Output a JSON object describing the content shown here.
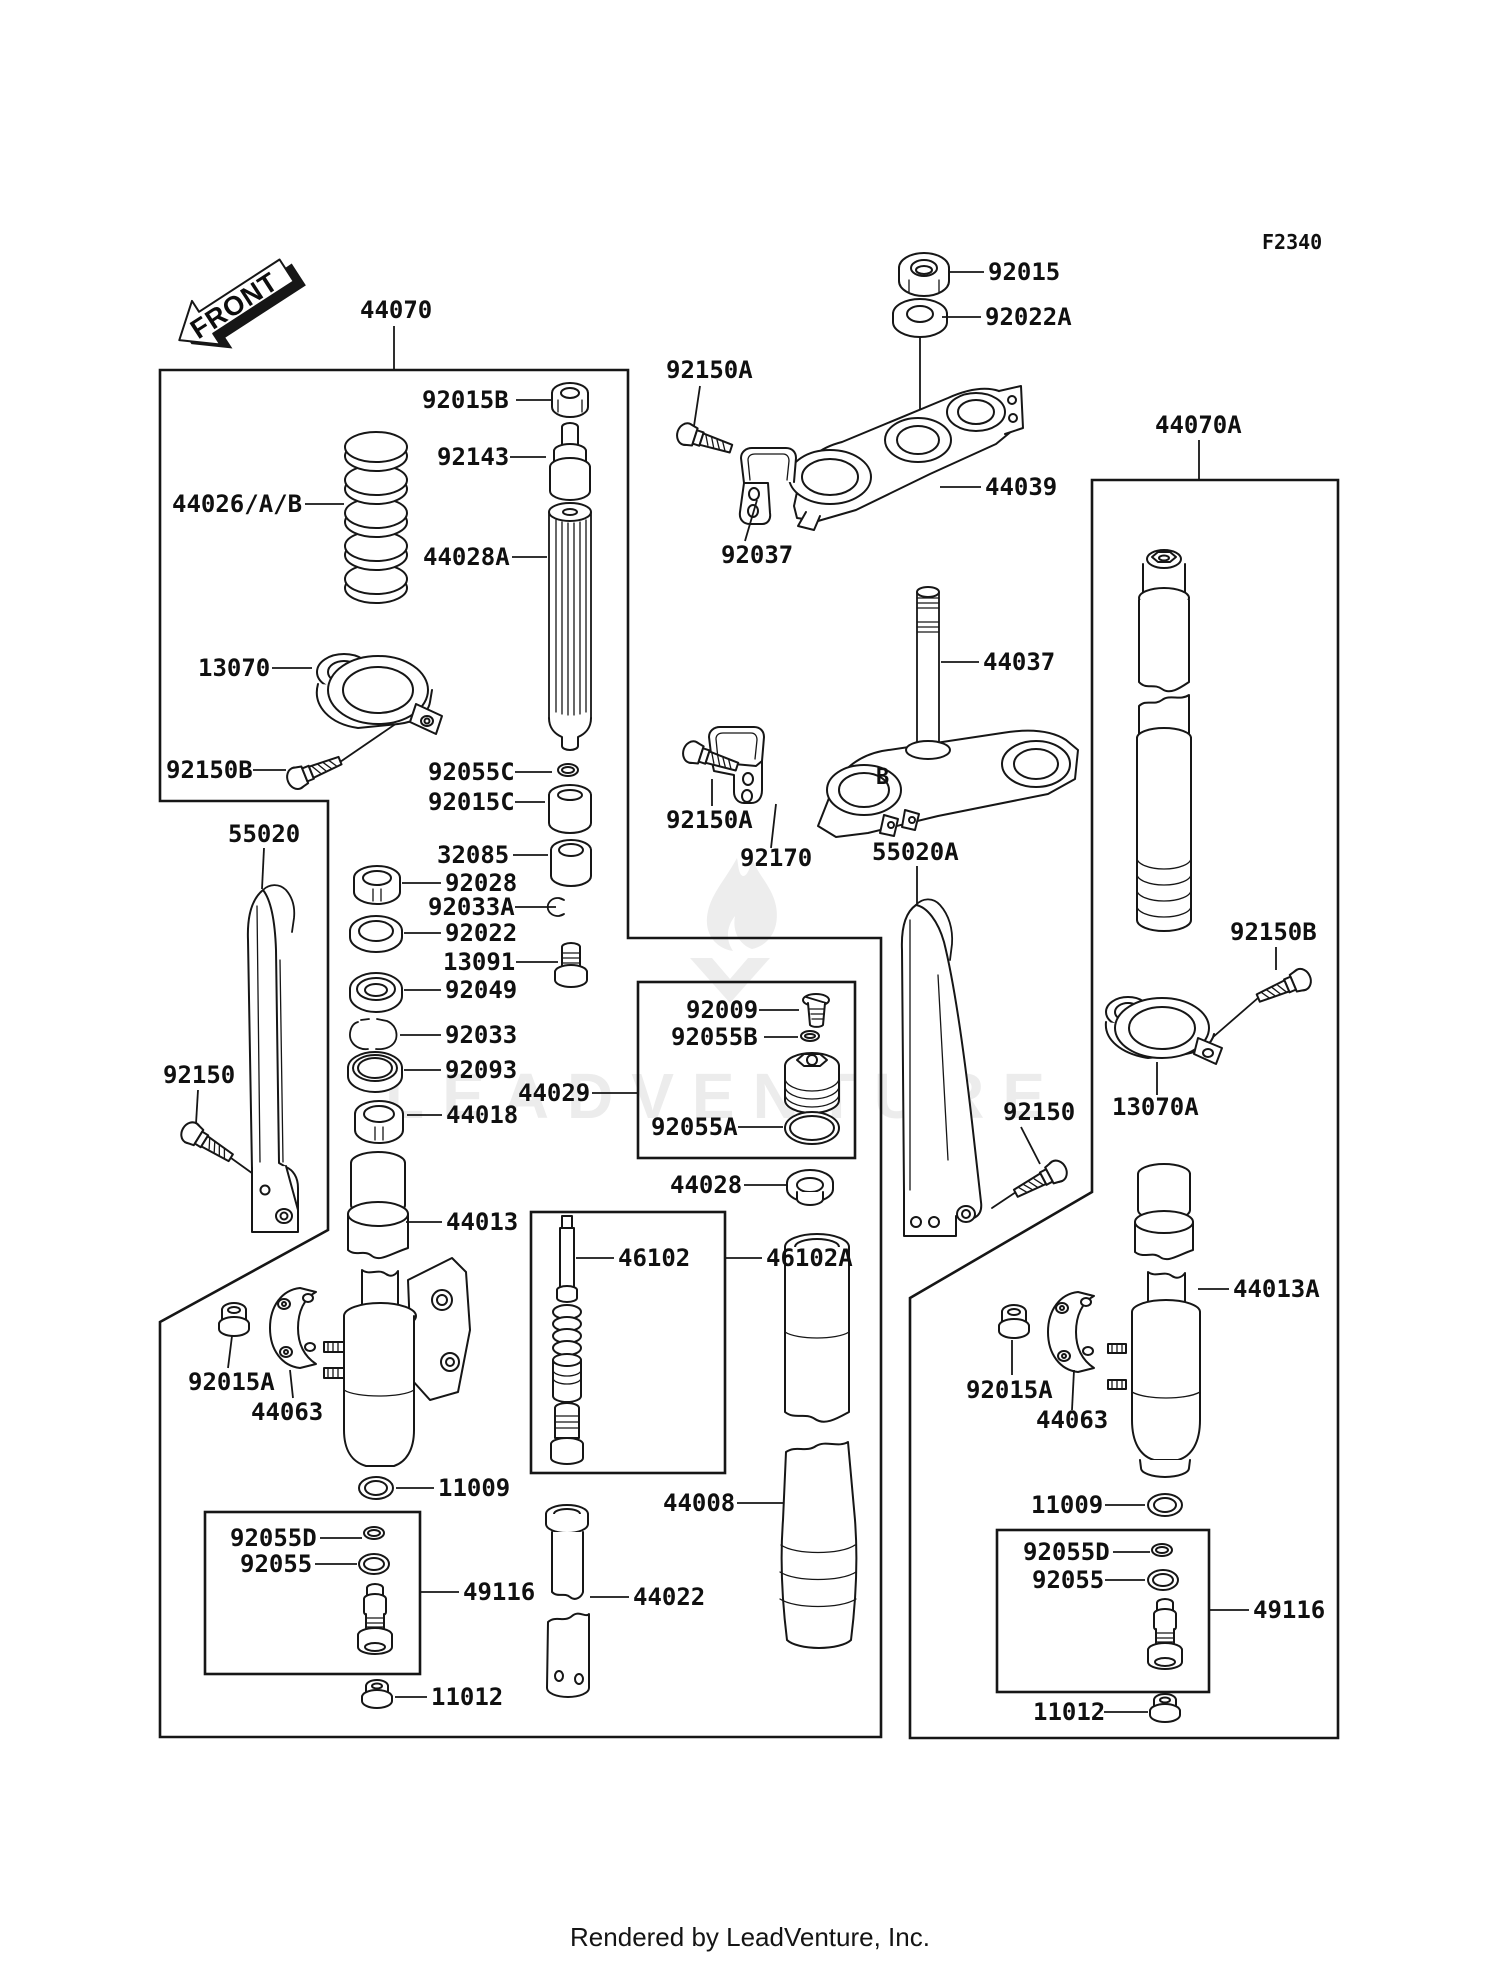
{
  "page": {
    "diagram_code": "F2340",
    "front_label": "FRONT",
    "clamp_marking": "B",
    "watermark_text": "LEADVENTURE",
    "footer_text": "Rendered by LeadVenture, Inc.",
    "line_color": "#161616",
    "background_color": "#ffffff",
    "watermark_color": "#ececec"
  },
  "diagram": {
    "labels": [
      {
        "id": "92015",
        "text": "92015",
        "x": 988,
        "y": 280,
        "leader": [
          984,
          272,
          948,
          272
        ]
      },
      {
        "id": "92022A",
        "text": "92022A",
        "x": 985,
        "y": 325,
        "leader": [
          981,
          317,
          942,
          317
        ]
      },
      {
        "id": "44070",
        "text": "44070",
        "x": 360,
        "y": 318,
        "leader": [
          394,
          326,
          394,
          369
        ]
      },
      {
        "id": "44070A",
        "text": "44070A",
        "x": 1155,
        "y": 433,
        "leader": [
          1199,
          440,
          1199,
          479
        ]
      },
      {
        "id": "92015B",
        "text": "92015B",
        "x": 422,
        "y": 408,
        "leader": [
          516,
          400,
          551,
          400
        ]
      },
      {
        "id": "92143",
        "text": "92143",
        "x": 437,
        "y": 465,
        "leader": [
          510,
          457,
          546,
          457
        ]
      },
      {
        "id": "44026AB",
        "text": "44026/A/B",
        "x": 172,
        "y": 512,
        "leader": [
          305,
          504,
          344,
          504
        ]
      },
      {
        "id": "44028A",
        "text": "44028A",
        "x": 423,
        "y": 565,
        "leader": [
          512,
          557,
          547,
          557
        ]
      },
      {
        "id": "13070",
        "text": "13070",
        "x": 198,
        "y": 676,
        "leader": [
          272,
          668,
          312,
          668
        ]
      },
      {
        "id": "92150B-left",
        "text": "92150B",
        "x": 166,
        "y": 778,
        "leader": [
          253,
          770,
          286,
          770
        ]
      },
      {
        "id": "92055C",
        "text": "92055C",
        "x": 428,
        "y": 780,
        "leader": [
          515,
          772,
          552,
          772
        ]
      },
      {
        "id": "92015C",
        "text": "92015C",
        "x": 428,
        "y": 810,
        "leader": [
          515,
          802,
          545,
          802
        ]
      },
      {
        "id": "55020",
        "text": "55020",
        "x": 228,
        "y": 842,
        "leader": [
          264,
          848,
          262,
          889
        ]
      },
      {
        "id": "32085",
        "text": "32085",
        "x": 437,
        "y": 863,
        "leader": [
          513,
          855,
          548,
          855
        ]
      },
      {
        "id": "92028",
        "text": "92028",
        "x": 445,
        "y": 891,
        "leader": [
          441,
          883,
          402,
          883
        ]
      },
      {
        "id": "92033A",
        "text": "92033A",
        "x": 428,
        "y": 915,
        "leader": [
          515,
          907,
          556,
          907
        ]
      },
      {
        "id": "92022",
        "text": "92022",
        "x": 445,
        "y": 941,
        "leader": [
          441,
          933,
          404,
          933
        ]
      },
      {
        "id": "13091",
        "text": "13091",
        "x": 443,
        "y": 970,
        "leader": [
          516,
          962,
          558,
          962
        ]
      },
      {
        "id": "92049",
        "text": "92049",
        "x": 445,
        "y": 998,
        "leader": [
          441,
          990,
          404,
          990
        ]
      },
      {
        "id": "92033",
        "text": "92033",
        "x": 445,
        "y": 1043,
        "leader": [
          441,
          1035,
          400,
          1035
        ]
      },
      {
        "id": "92093",
        "text": "92093",
        "x": 445,
        "y": 1078,
        "leader": [
          441,
          1070,
          404,
          1070
        ]
      },
      {
        "id": "44029",
        "text": "44029",
        "x": 518,
        "y": 1101,
        "leader": [
          592,
          1093,
          637,
          1093
        ]
      },
      {
        "id": "44018",
        "text": "44018",
        "x": 446,
        "y": 1123,
        "leader": [
          442,
          1115,
          407,
          1115
        ]
      },
      {
        "id": "92150-left",
        "text": "92150",
        "x": 163,
        "y": 1083,
        "leader": [
          198,
          1090,
          196,
          1124
        ]
      },
      {
        "id": "44013",
        "text": "44013",
        "x": 446,
        "y": 1230,
        "leader": [
          442,
          1222,
          406,
          1222
        ]
      },
      {
        "id": "92015A-left",
        "text": "92015A",
        "x": 188,
        "y": 1390,
        "leader": [
          232,
          1336,
          228,
          1368
        ]
      },
      {
        "id": "44063-left",
        "text": "44063",
        "x": 251,
        "y": 1420,
        "leader": [
          293,
          1398,
          290,
          1370
        ]
      },
      {
        "id": "11009-left",
        "text": "11009",
        "x": 438,
        "y": 1496,
        "leader": [
          434,
          1488,
          396,
          1488
        ]
      },
      {
        "id": "92055D-left",
        "text": "92055D",
        "x": 230,
        "y": 1546,
        "leader": [
          320,
          1538,
          362,
          1538
        ]
      },
      {
        "id": "92055-left",
        "text": "92055",
        "x": 240,
        "y": 1572,
        "leader": [
          315,
          1564,
          357,
          1564
        ]
      },
      {
        "id": "49116-left",
        "text": "49116",
        "x": 463,
        "y": 1600,
        "leader": [
          459,
          1592,
          420,
          1592
        ]
      },
      {
        "id": "11012-left",
        "text": "11012",
        "x": 431,
        "y": 1705,
        "leader": [
          427,
          1697,
          395,
          1697
        ]
      },
      {
        "id": "92150A-top",
        "text": "92150A",
        "x": 666,
        "y": 378,
        "leader": [
          700,
          386,
          694,
          426
        ]
      },
      {
        "id": "92037",
        "text": "92037",
        "x": 721,
        "y": 563,
        "leader": [
          757,
          500,
          745,
          541
        ]
      },
      {
        "id": "44039",
        "text": "44039",
        "x": 985,
        "y": 495,
        "leader": [
          981,
          487,
          940,
          487
        ]
      },
      {
        "id": "44037",
        "text": "44037",
        "x": 983,
        "y": 670,
        "leader": [
          979,
          662,
          941,
          662
        ]
      },
      {
        "id": "92150A-mid",
        "text": "92150A",
        "x": 666,
        "y": 828,
        "leader": [
          712,
          779,
          712,
          806
        ]
      },
      {
        "id": "92170",
        "text": "92170",
        "x": 740,
        "y": 866,
        "leader": [
          776,
          804,
          771,
          848
        ]
      },
      {
        "id": "55020A",
        "text": "55020A",
        "x": 872,
        "y": 860,
        "leader": [
          917,
          866,
          917,
          904
        ]
      },
      {
        "id": "92150-right",
        "text": "92150",
        "x": 1003,
        "y": 1120,
        "leader": [
          1021,
          1127,
          1040,
          1164
        ]
      },
      {
        "id": "92009",
        "text": "92009",
        "x": 686,
        "y": 1018,
        "leader": [
          759,
          1010,
          799,
          1010
        ]
      },
      {
        "id": "92055B",
        "text": "92055B",
        "x": 671,
        "y": 1045,
        "leader": [
          764,
          1037,
          798,
          1037
        ]
      },
      {
        "id": "92055A",
        "text": "92055A",
        "x": 651,
        "y": 1135,
        "leader": [
          738,
          1127,
          783,
          1127
        ]
      },
      {
        "id": "44028",
        "text": "44028",
        "x": 670,
        "y": 1193,
        "leader": [
          744,
          1185,
          786,
          1185
        ]
      },
      {
        "id": "46102",
        "text": "46102",
        "x": 618,
        "y": 1266,
        "leader": [
          614,
          1258,
          576,
          1258
        ]
      },
      {
        "id": "46102A",
        "text": "46102A",
        "x": 766,
        "y": 1266,
        "leader": [
          762,
          1258,
          725,
          1258
        ]
      },
      {
        "id": "44008",
        "text": "44008",
        "x": 663,
        "y": 1511,
        "leader": [
          737,
          1503,
          783,
          1503
        ]
      },
      {
        "id": "44022",
        "text": "44022",
        "x": 633,
        "y": 1605,
        "leader": [
          629,
          1597,
          590,
          1597
        ]
      },
      {
        "id": "13070A",
        "text": "13070A",
        "x": 1112,
        "y": 1115,
        "leader": [
          1157,
          1062,
          1157,
          1095
        ]
      },
      {
        "id": "92150B-right",
        "text": "92150B",
        "x": 1230,
        "y": 940,
        "leader": [
          1276,
          947,
          1276,
          970
        ]
      },
      {
        "id": "44013A",
        "text": "44013A",
        "x": 1233,
        "y": 1297,
        "leader": [
          1229,
          1289,
          1198,
          1289
        ]
      },
      {
        "id": "92015A-right",
        "text": "92015A",
        "x": 966,
        "y": 1398,
        "leader": [
          1012,
          1340,
          1012,
          1375
        ]
      },
      {
        "id": "44063-right",
        "text": "44063",
        "x": 1036,
        "y": 1428,
        "leader": [
          1074,
          1370,
          1072,
          1410
        ]
      },
      {
        "id": "11009-right",
        "text": "11009",
        "x": 1031,
        "y": 1513,
        "leader": [
          1105,
          1505,
          1145,
          1505
        ]
      },
      {
        "id": "92055D-right",
        "text": "92055D",
        "x": 1023,
        "y": 1560,
        "leader": [
          1113,
          1552,
          1150,
          1552
        ]
      },
      {
        "id": "92055-right",
        "text": "92055",
        "x": 1032,
        "y": 1588,
        "leader": [
          1105,
          1580,
          1145,
          1580
        ]
      },
      {
        "id": "49116-right",
        "text": "49116",
        "x": 1253,
        "y": 1618,
        "leader": [
          1249,
          1610,
          1209,
          1610
        ]
      },
      {
        "id": "11012-right",
        "text": "11012",
        "x": 1033,
        "y": 1720,
        "leader": [
          1104,
          1712,
          1148,
          1712
        ]
      }
    ]
  }
}
